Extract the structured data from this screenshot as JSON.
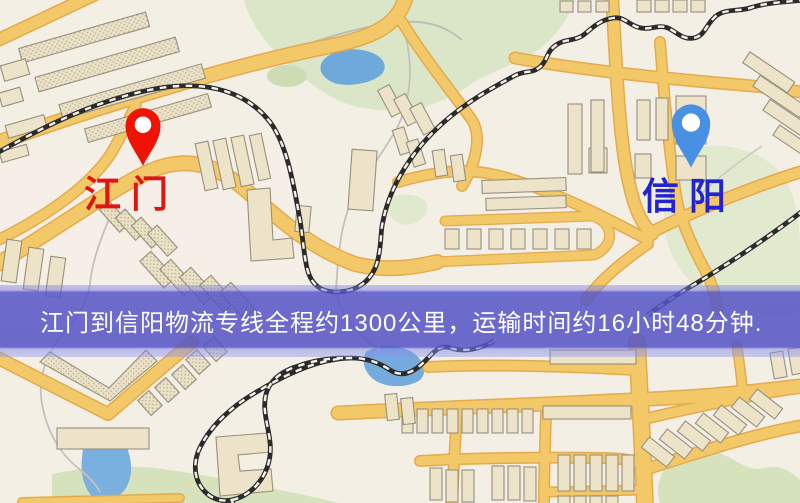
{
  "banner": {
    "text": "江门到信阳物流专线全程约1300公里，运输时间约16小时48分钟.",
    "route_origin": "江门",
    "route_destination": "信阳",
    "distance_text": "约1300公里",
    "duration_text": "约16小时48分钟",
    "background_color": "#5656c6",
    "text_color": "#ffffff"
  },
  "markers": {
    "origin": {
      "label": "江门",
      "pin_color": "#ee1207",
      "label_color": "#e01410"
    },
    "destination": {
      "label": "信阳",
      "pin_color": "#4a90e2",
      "label_color": "#2424cd"
    }
  },
  "map": {
    "palette": {
      "background": "#f4efe5",
      "road_fill": "#f3c868",
      "road_casing": "#e3ab4d",
      "building_fill": "#ece3c9",
      "building_stroke": "#97907d",
      "park_green": "#dbe6c8",
      "water_blue": "#74aadb",
      "railway_dark": "#2b2b2b"
    }
  }
}
